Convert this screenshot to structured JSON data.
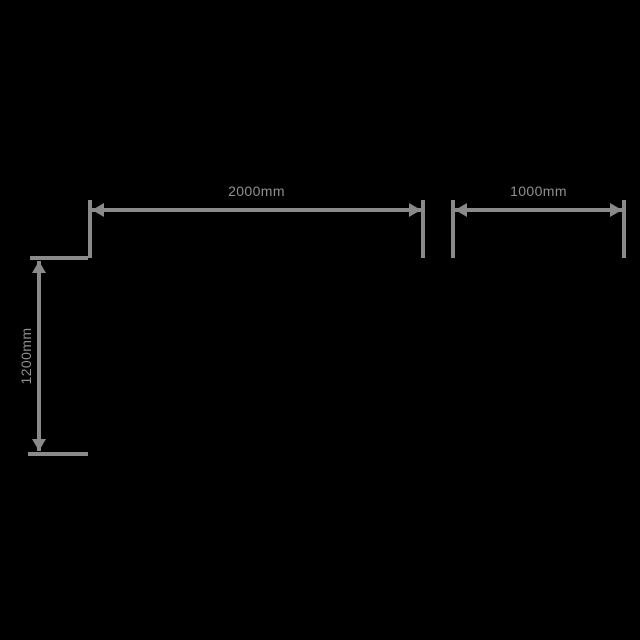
{
  "canvas": {
    "background": "#000000"
  },
  "style": {
    "line_color": "#8a8a8a",
    "text_color": "#8f8f8f"
  },
  "diagram": {
    "type": "dimension-drawing",
    "unit": "mm",
    "dimensions": [
      {
        "id": "top-width",
        "orientation": "horizontal",
        "label": "2000mm",
        "value": 2000
      },
      {
        "id": "top-right-width",
        "orientation": "horizontal",
        "label": "1000mm",
        "value": 1000
      },
      {
        "id": "left-height",
        "orientation": "vertical",
        "label": "1200mm",
        "value": 1200
      }
    ]
  }
}
